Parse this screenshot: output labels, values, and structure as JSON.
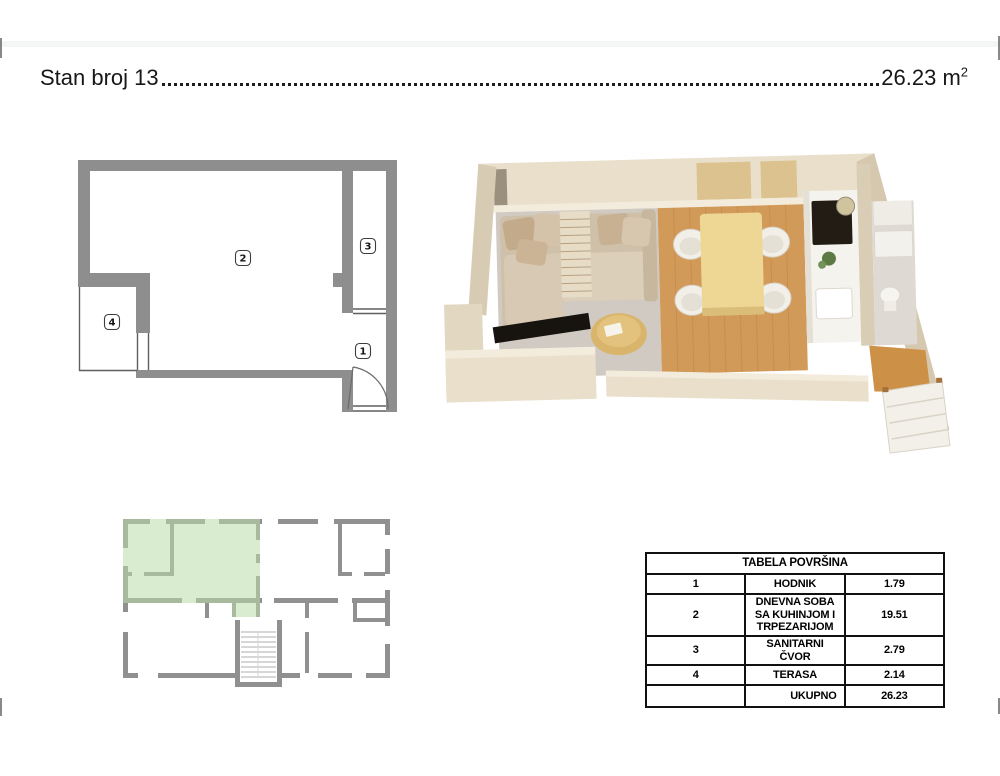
{
  "header": {
    "apartment_label": "Stan broj 13",
    "area_value": "26.23",
    "area_unit_base": "m",
    "area_unit_exponent": "2"
  },
  "floor_plan_2d": {
    "room_labels": [
      "1",
      "2",
      "3",
      "4"
    ]
  },
  "areas_table": {
    "title": "TABELA POVRŠINA",
    "rows": [
      {
        "num": "1",
        "name": "HODNIK",
        "area": "1.79"
      },
      {
        "num": "2",
        "name": "DNEVNA SOBA SA KUHINJOM I TRPEZARIJOM",
        "area": "19.51"
      },
      {
        "num": "3",
        "name": "SANITARNI ČVOR",
        "area": "2.79"
      },
      {
        "num": "4",
        "name": "TERASA",
        "area": "2.14"
      }
    ],
    "total_label": "UKUPNO",
    "total_value": "26.23"
  },
  "colors": {
    "plan_wall_gray": "#8e8e8e",
    "keyplan_wall_gray": "#909090",
    "apartment_highlight_green": "#b9dcaa",
    "wood_floor": "#d29a58",
    "render_wall_beige": "#e9dfcb",
    "table_border_black": "#111111"
  }
}
